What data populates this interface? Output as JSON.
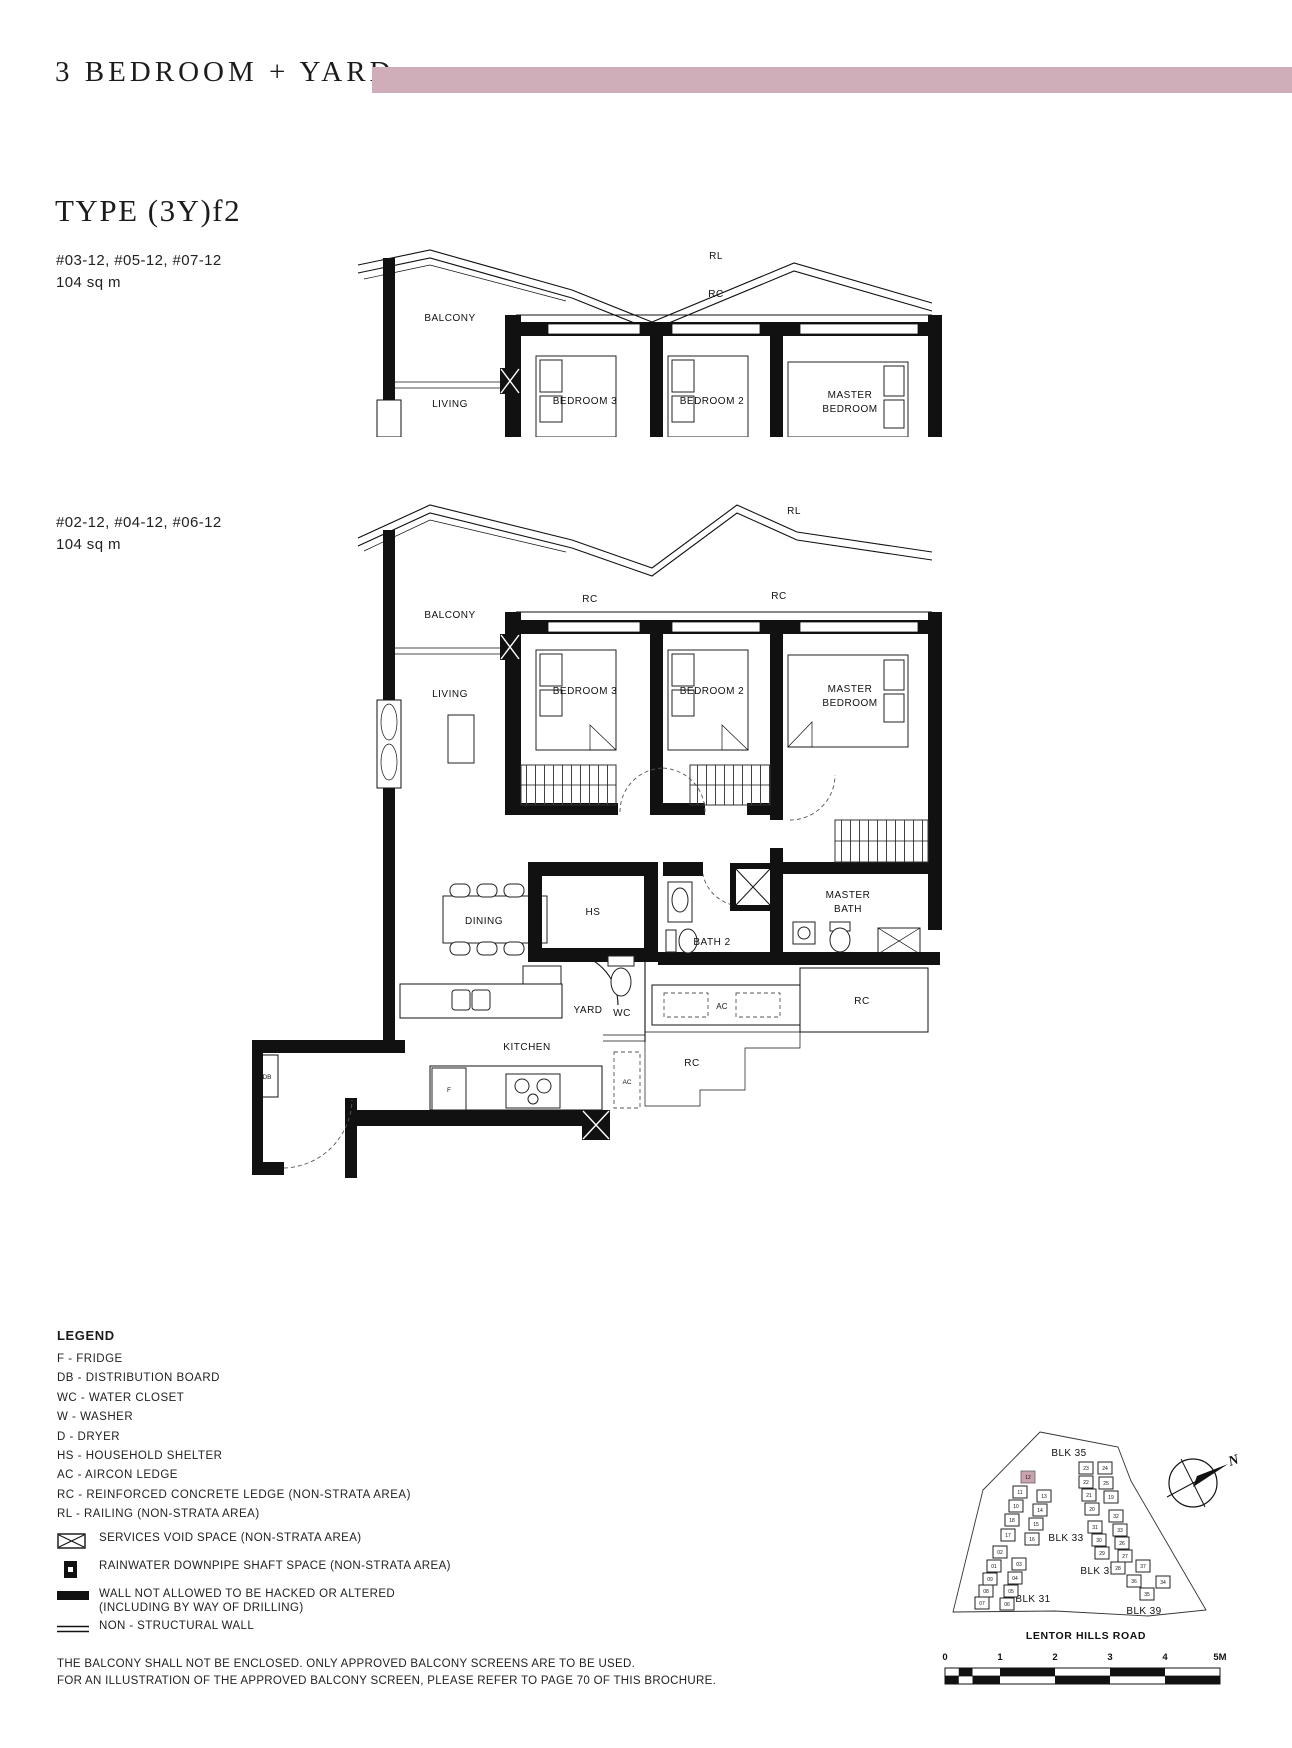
{
  "header": {
    "title": "3 BEDROOM + YARD",
    "type_heading": "TYPE (3Y)f2",
    "accent_color": "#cfaeb9"
  },
  "plans": [
    {
      "units": "#03-12, #05-12, #07-12",
      "area": "104 sq m",
      "labels": {
        "balcony": "BALCONY",
        "living": "LIVING",
        "bedroom3": "BEDROOM 3",
        "bedroom2": "BEDROOM 2",
        "master1": "MASTER",
        "master2": "BEDROOM",
        "rl": "RL",
        "rc": "RC"
      }
    },
    {
      "units": "#02-12, #04-12, #06-12",
      "area": "104 sq m",
      "labels": {
        "balcony": "BALCONY",
        "living": "LIVING",
        "bedroom3": "BEDROOM 3",
        "bedroom2": "BEDROOM 2",
        "master1": "MASTER",
        "master2": "BEDROOM",
        "rl": "RL",
        "rc_left": "RC",
        "rc_right": "RC",
        "dining": "DINING",
        "hs": "HS",
        "bath2": "BATH 2",
        "mbath1": "MASTER",
        "mbath2": "BATH",
        "wd": "W,D",
        "yard": "YARD",
        "wc": "WC",
        "ac": "AC",
        "rc_mid": "RC",
        "kitchen": "KITCHEN",
        "f": "F",
        "db": "DB",
        "ac_low": "AC",
        "rc_low": "RC"
      }
    }
  ],
  "legend": {
    "title": "LEGEND",
    "items": [
      "F - FRIDGE",
      "DB - DISTRIBUTION BOARD",
      "WC - WATER CLOSET",
      "W - WASHER",
      "D - DRYER",
      "HS - HOUSEHOLD SHELTER",
      "AC - AIRCON LEDGE",
      "RC - REINFORCED CONCRETE LEDGE (NON-STRATA AREA)",
      "RL - RAILING (NON-STRATA AREA)"
    ],
    "symbols": [
      {
        "label": "SERVICES VOID SPACE (NON-STRATA AREA)"
      },
      {
        "label": "RAINWATER DOWNPIPE SHAFT SPACE (NON-STRATA AREA)"
      },
      {
        "label": "WALL NOT ALLOWED TO BE HACKED OR ALTERED",
        "label2": "(INCLUDING BY WAY OF DRILLING)"
      },
      {
        "label": "NON - STRUCTURAL WALL"
      }
    ]
  },
  "sitemap": {
    "blocks": [
      "BLK 35",
      "BLK 33",
      "BLK 31",
      "BLK 37",
      "BLK 39"
    ],
    "road": "LENTOR HILLS ROAD",
    "north": "N",
    "highlight_color": "#c9a3ad",
    "units_left": [
      {
        "n": "12"
      },
      {
        "n": "11"
      },
      {
        "n": "13"
      },
      {
        "n": "10"
      },
      {
        "n": "14"
      },
      {
        "n": "18"
      },
      {
        "n": "15"
      },
      {
        "n": "17"
      },
      {
        "n": "16"
      },
      {
        "n": "02"
      },
      {
        "n": "01"
      },
      {
        "n": "03"
      },
      {
        "n": "09"
      },
      {
        "n": "04"
      },
      {
        "n": "08"
      },
      {
        "n": "05"
      },
      {
        "n": "07"
      },
      {
        "n": "06"
      }
    ],
    "units_right": [
      {
        "n": "23"
      },
      {
        "n": "24"
      },
      {
        "n": "22"
      },
      {
        "n": "25"
      },
      {
        "n": "21"
      },
      {
        "n": "19"
      },
      {
        "n": "20"
      },
      {
        "n": "32"
      },
      {
        "n": "31"
      },
      {
        "n": "33"
      },
      {
        "n": "30"
      },
      {
        "n": "26"
      },
      {
        "n": "29"
      },
      {
        "n": "27"
      },
      {
        "n": "28"
      },
      {
        "n": "37"
      },
      {
        "n": "36"
      },
      {
        "n": "34"
      },
      {
        "n": "35"
      }
    ]
  },
  "scalebar": {
    "ticks": [
      "0",
      "1",
      "2",
      "3",
      "4",
      "5M"
    ]
  },
  "footer": {
    "line1": "THE BALCONY SHALL NOT BE ENCLOSED. ONLY APPROVED BALCONY SCREENS ARE TO BE USED.",
    "line2": "FOR AN ILLUSTRATION OF THE APPROVED BALCONY SCREEN, PLEASE REFER TO PAGE 70 OF THIS BROCHURE."
  }
}
